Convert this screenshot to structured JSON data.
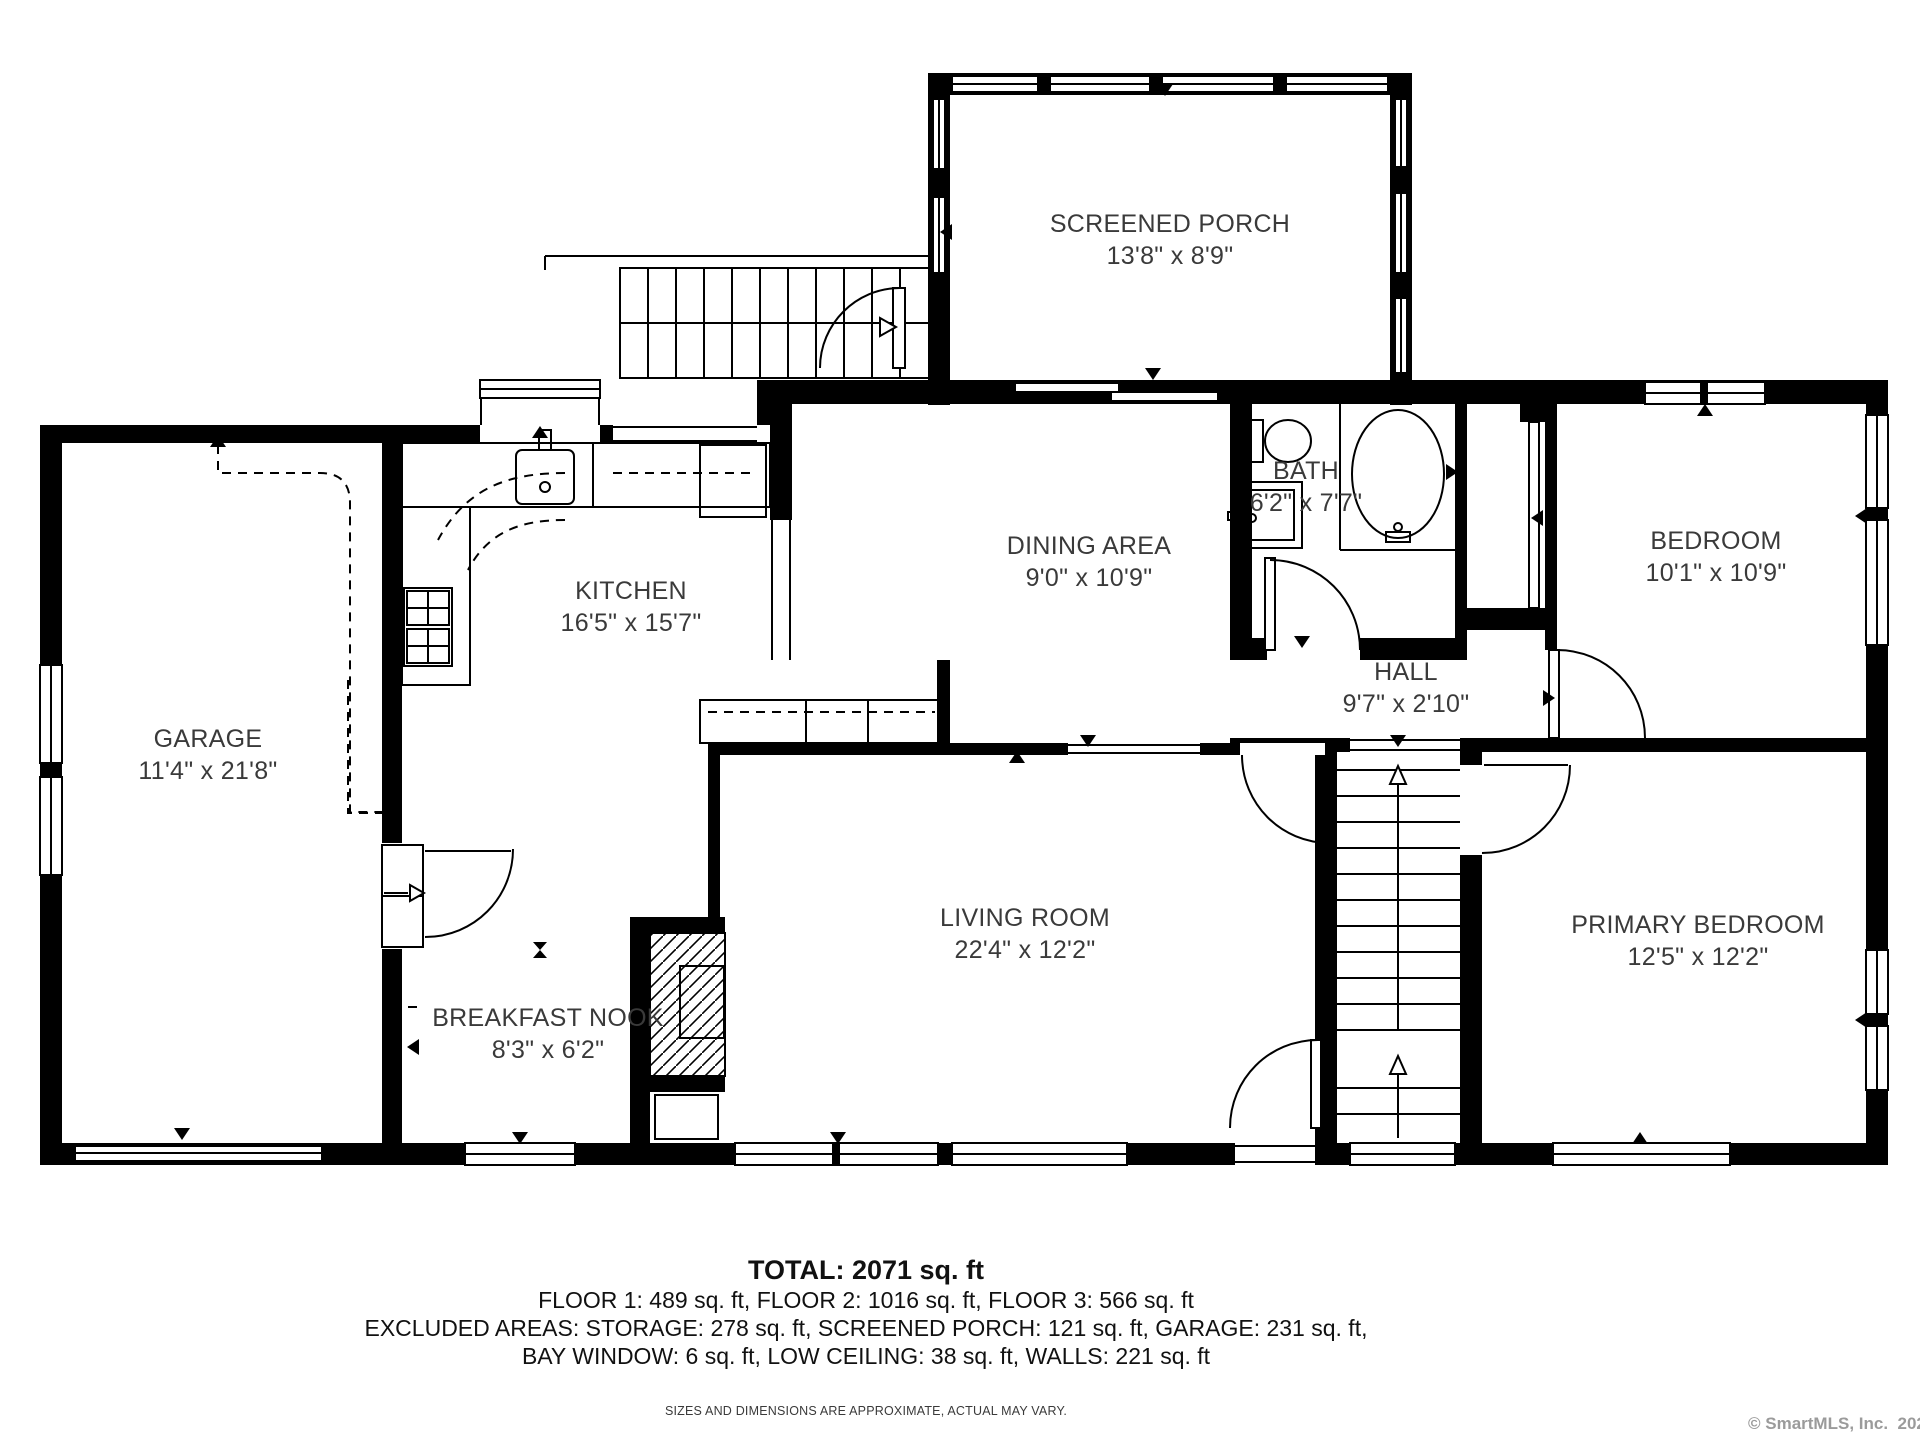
{
  "colors": {
    "wall": "#000000",
    "room_label": "#3a3a3a",
    "summary_text": "#111111",
    "watermark": "#9b9b9b"
  },
  "rooms": [
    {
      "name": "SCREENED PORCH",
      "dims": "13'8\" x 8'9\""
    },
    {
      "name": "KITCHEN",
      "dims": "16'5\" x 15'7\""
    },
    {
      "name": "DINING AREA",
      "dims": "9'0\" x 10'9\""
    },
    {
      "name": "BATH",
      "dims": "6'2\" x 7'7\""
    },
    {
      "name": "BEDROOM",
      "dims": "10'1\" x 10'9\""
    },
    {
      "name": "GARAGE",
      "dims": "11'4\" x 21'8\""
    },
    {
      "name": "HALL",
      "dims": "9'7\" x 2'10\""
    },
    {
      "name": "LIVING ROOM",
      "dims": "22'4\" x 12'2\""
    },
    {
      "name": "PRIMARY BEDROOM",
      "dims": "12'5\" x 12'2\""
    },
    {
      "name": "BREAKFAST NOOK",
      "dims": "8'3\" x 6'2\""
    }
  ],
  "summary": {
    "total": "TOTAL: 2071 sq. ft",
    "floors": "FLOOR 1: 489 sq. ft, FLOOR 2: 1016 sq. ft, FLOOR 3: 566 sq. ft",
    "excluded_line1": "EXCLUDED AREAS: STORAGE: 278 sq. ft, SCREENED PORCH: 121 sq. ft, GARAGE: 231 sq. ft,",
    "excluded_line2": "BAY WINDOW: 6 sq. ft, LOW CEILING: 38 sq. ft, WALLS: 221 sq. ft",
    "disclaimer": "SIZES AND DIMENSIONS ARE APPROXIMATE, ACTUAL MAY VARY."
  },
  "watermark": "© SmartMLS, Inc.  2025"
}
